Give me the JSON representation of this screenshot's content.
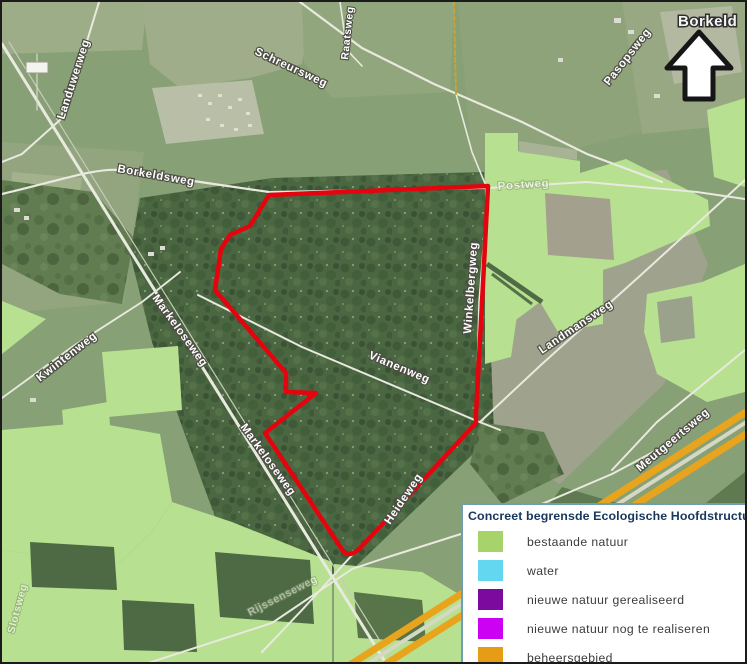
{
  "map": {
    "area_label": "Borkeld",
    "roads": {
      "landuwerweg": "Landuwerweg",
      "schreursweg": "Schreursweg",
      "raatsweg": "Raatsweg",
      "borkeldsweg": "Borkeldsweg",
      "pasopsweg": "Pasopsweg",
      "postweg": "Postweg",
      "markeloseweg": "Markeloseweg",
      "kwintenweg": "Kwintenweg",
      "vianenweg": "Vianenweg",
      "winkelbergweg": "Winkelbergweg",
      "landmansweg": "Landmansweg",
      "meutgeertsweg": "Meutgeertsweg",
      "heideweg": "Heideweg",
      "slotsweg": "Slotsweg",
      "rijssenseweg": "Rijssenseweg"
    },
    "colors": {
      "boundary_red": "#e4040e",
      "overlay_green": "#b7e090",
      "beheersgebied_orange": "#e8a41c"
    }
  },
  "legend": {
    "title": "Concreet begrensde Ecologische Hoofdstructuur",
    "items": [
      {
        "label": "bestaande natuur",
        "color": "#a7d36b"
      },
      {
        "label": "water",
        "color": "#63d7f0"
      },
      {
        "label": "nieuwe natuur gerealiseerd",
        "color": "#7d0a9e"
      },
      {
        "label": "nieuwe natuur nog te realiseren",
        "color": "#cc00f2"
      },
      {
        "label": "beheersgebied",
        "color": "#e69c15"
      }
    ]
  }
}
